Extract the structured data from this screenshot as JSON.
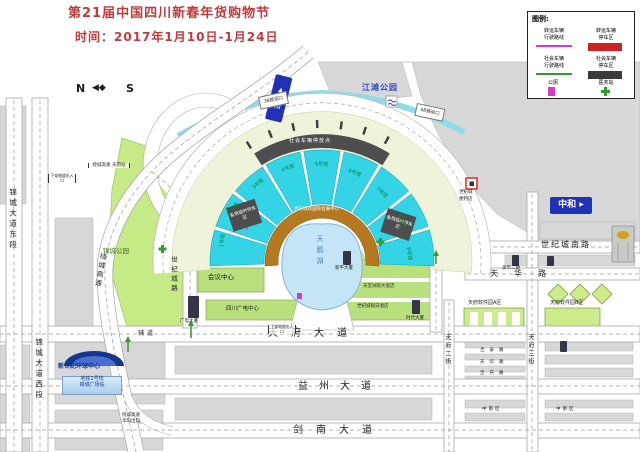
{
  "title": {
    "line1": "第21届中国四川新春年货购物节",
    "line2": "时间：2017年1月10日-1月24日"
  },
  "legend": {
    "title": "图例:",
    "items": [
      {
        "label": "转运车辆\n行驶路线"
      },
      {
        "label": "转运车辆\n停车区"
      },
      {
        "label": "社会车辆\n行驶路线"
      },
      {
        "label": "社会车辆\n停车区"
      },
      {
        "label": "公厕"
      },
      {
        "label": "医务站"
      }
    ]
  },
  "compass": {
    "n": "N",
    "s": "S"
  },
  "signs": {
    "zhonghe_top": "中和",
    "zhonghe_right": "中和",
    "jiangtan_park": "江滩公园"
  },
  "venue": {
    "halls": [
      "1号馆",
      "2号馆",
      "3号馆",
      "4号馆",
      "5号馆",
      "6号馆",
      "7号馆",
      "8号馆",
      "9号馆"
    ],
    "parking_arc": "社会车辆停放点",
    "name": "世纪城新国际会展中心",
    "lake": "天鹅湖",
    "backup_left": "备用临时停车区",
    "backup_right": "备用临时停车区",
    "gate_left": "3B搭运口",
    "gate_right": "6B搭运口"
  },
  "roads": {
    "tianfu_ave": "天府大道",
    "yizhou_ave": "益州大道",
    "jiannan_ave": "剑南大道",
    "shijicheng_rd": "世纪城路",
    "shijicheng_south_rd": "世纪城南路",
    "tianhua_rd": "天华路",
    "jincheng_east": "锦城大道东段",
    "jincheng_west": "锦城大道西段",
    "raocheng_exp": "绕城高速",
    "toll_station": "绕城高速\n天府站",
    "huayang_exit": "绕城高速\n华阳出口",
    "tianfu_2nd_st": "天府二街",
    "tianfu_3rd_st": "天府三街",
    "jitai_rd": "吉泰路",
    "tianhua_rd_s": "天华路",
    "jiqing_rd": "吉庆路",
    "fudao": "辅道",
    "tunnel_entrance": "下穿隧道出入口"
  },
  "places": {
    "jincheng_park": "锦城公园",
    "conference_center": "会议中心",
    "radio_tv_center": "四川广电中心",
    "radio_tower": "广电大厦",
    "global_center": "新世纪环球中心",
    "metro_line": "地铁1号线",
    "metro_station": "锦城广场站",
    "software_park_a": "天府软件园A区",
    "software_park_b": "天府软件园B区",
    "xinping_tower": "新平大厦",
    "intercontinental": "天堂洲际大饭店",
    "holiday_inn": "世纪城假日酒店",
    "shidai_tower": "时代大厦",
    "meinian": "美年二期",
    "store_line1": "世纪城",
    "store_line2": "便利店",
    "block_south_1": "中南区",
    "block_south_2": "中南区"
  },
  "colors": {
    "accent_red": "#c23a3a",
    "sign_blue": "#2031b5",
    "hall_cyan": "#33d4e6",
    "park_green": "#c6ea85",
    "lake_blue": "#c4e5f6",
    "route_magenta": "#d83ad0",
    "route_green": "#2f9e2f"
  }
}
